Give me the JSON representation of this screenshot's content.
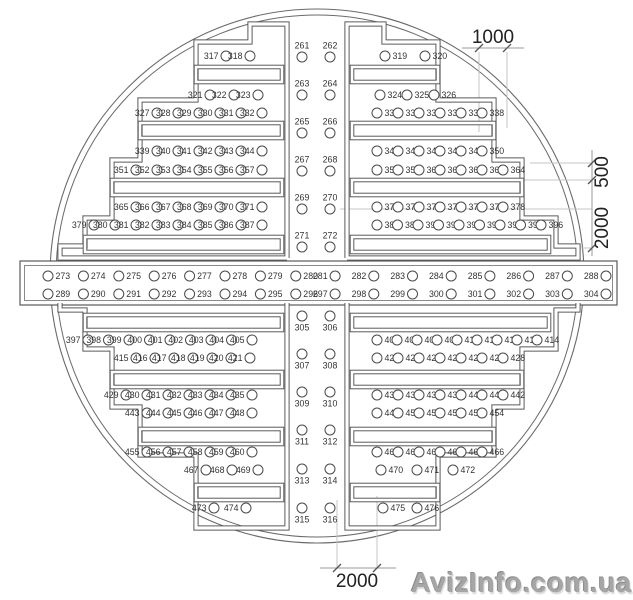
{
  "drawing": {
    "title": "circular-hole-layout-plan",
    "dimensions": {
      "top": "1000",
      "right_upper": "500",
      "right_lower": "2000",
      "bottom": "2000"
    },
    "watermark": "AvizInfo.com.ua",
    "colors": {
      "line": "#5a5a5a",
      "hole_stroke": "#4a4a4a",
      "dim_text": "#222222",
      "ext_line": "#c4c4c4",
      "watermark": "#a6a6a6"
    },
    "rows": [
      {
        "nums": [
          317,
          318
        ],
        "y": 56,
        "mode": "before",
        "x": 250,
        "step": 24
      },
      {
        "nums": [
          321,
          322,
          323
        ],
        "y": 95,
        "mode": "before",
        "x": 258,
        "step": 24
      },
      {
        "nums": [
          327,
          328,
          329,
          330,
          331,
          332
        ],
        "y": 113,
        "mode": "before",
        "x": 262,
        "step": 21
      },
      {
        "nums": [
          339,
          340,
          341,
          342,
          343,
          344
        ],
        "y": 151,
        "mode": "before",
        "x": 262,
        "step": 21
      },
      {
        "nums": [
          351,
          352,
          353,
          354,
          355,
          356,
          357
        ],
        "y": 170,
        "mode": "before",
        "x": 262,
        "step": 21
      },
      {
        "nums": [
          365,
          366,
          367,
          368,
          369,
          370,
          371
        ],
        "y": 207,
        "mode": "before",
        "x": 262,
        "step": 21
      },
      {
        "nums": [
          379,
          380,
          381,
          382,
          383,
          384,
          385,
          386,
          387
        ],
        "y": 225,
        "mode": "before",
        "x": 262,
        "step": 21
      },
      {
        "nums": [
          319,
          320
        ],
        "y": 56,
        "mode": "after",
        "x": 385,
        "step": 40
      },
      {
        "nums": [
          324,
          325,
          326
        ],
        "y": 95,
        "mode": "after",
        "x": 380,
        "step": 27
      },
      {
        "nums": [
          333,
          334,
          335,
          336,
          337,
          338
        ],
        "y": 113,
        "mode": "after",
        "x": 377,
        "step": 21
      },
      {
        "nums": [
          345,
          346,
          347,
          348,
          349,
          350
        ],
        "y": 151,
        "mode": "after",
        "x": 377,
        "step": 21
      },
      {
        "nums": [
          358,
          359,
          360,
          361,
          362,
          363,
          364
        ],
        "y": 170,
        "mode": "after",
        "x": 377,
        "step": 21
      },
      {
        "nums": [
          372,
          373,
          374,
          375,
          376,
          377,
          378
        ],
        "y": 207,
        "mode": "after",
        "x": 377,
        "step": 21
      },
      {
        "nums": [
          388,
          389,
          390,
          391,
          392,
          393,
          394,
          395,
          396
        ],
        "y": 225,
        "mode": "after",
        "x": 377,
        "step": 20.5
      },
      {
        "nums": [
          261,
          262
        ],
        "y": 57,
        "mode": "above",
        "x": 302,
        "step": 28
      },
      {
        "nums": [
          263,
          264
        ],
        "y": 95,
        "mode": "above",
        "x": 302,
        "step": 28
      },
      {
        "nums": [
          265,
          266
        ],
        "y": 133,
        "mode": "above",
        "x": 302,
        "step": 28
      },
      {
        "nums": [
          267,
          268
        ],
        "y": 171,
        "mode": "above",
        "x": 302,
        "step": 28
      },
      {
        "nums": [
          269,
          270
        ],
        "y": 209,
        "mode": "above",
        "x": 302,
        "step": 28
      },
      {
        "nums": [
          271,
          272
        ],
        "y": 247,
        "mode": "above",
        "x": 302,
        "step": 28
      },
      {
        "nums": [
          273,
          274,
          275,
          276,
          277,
          278,
          279,
          280
        ],
        "y": 276,
        "mode": "after",
        "x": 48,
        "step": 35.4
      },
      {
        "nums": [
          281,
          282,
          283,
          284,
          285,
          286,
          287,
          288
        ],
        "y": 276,
        "mode": "before",
        "x": 606,
        "step": 38.7
      },
      {
        "nums": [
          289,
          290,
          291,
          292,
          293,
          294,
          295,
          296
        ],
        "y": 294,
        "mode": "after",
        "x": 48,
        "step": 35.4
      },
      {
        "nums": [
          297,
          298,
          299,
          300,
          301,
          302,
          303,
          304
        ],
        "y": 294,
        "mode": "before",
        "x": 606,
        "step": 38.7
      },
      {
        "nums": [
          305,
          306
        ],
        "y": 316,
        "mode": "below",
        "x": 302,
        "step": 28
      },
      {
        "nums": [
          307,
          308
        ],
        "y": 354,
        "mode": "below",
        "x": 302,
        "step": 28
      },
      {
        "nums": [
          309,
          310
        ],
        "y": 392,
        "mode": "below",
        "x": 302,
        "step": 28
      },
      {
        "nums": [
          311,
          312
        ],
        "y": 430,
        "mode": "below",
        "x": 302,
        "step": 28
      },
      {
        "nums": [
          313,
          314
        ],
        "y": 469,
        "mode": "below",
        "x": 302,
        "step": 28
      },
      {
        "nums": [
          315,
          316
        ],
        "y": 508,
        "mode": "below",
        "x": 302,
        "step": 28
      },
      {
        "nums": [
          397,
          398,
          399,
          400,
          401,
          402,
          403,
          404,
          405
        ],
        "y": 340,
        "mode": "before",
        "x": 252,
        "step": 20.5
      },
      {
        "nums": [
          415,
          416,
          417,
          418,
          419,
          420,
          421
        ],
        "y": 358,
        "mode": "before",
        "x": 250,
        "step": 19
      },
      {
        "nums": [
          429,
          430,
          431,
          432,
          433,
          434,
          435
        ],
        "y": 395,
        "mode": "before",
        "x": 252,
        "step": 21
      },
      {
        "nums": [
          443,
          444,
          445,
          446,
          447,
          448
        ],
        "y": 413,
        "mode": "before",
        "x": 252,
        "step": 21
      },
      {
        "nums": [
          455,
          456,
          457,
          458,
          459,
          460
        ],
        "y": 452,
        "mode": "before",
        "x": 252,
        "step": 21
      },
      {
        "nums": [
          467,
          468,
          469
        ],
        "y": 470,
        "mode": "before",
        "x": 258,
        "step": 26
      },
      {
        "nums": [
          473,
          474
        ],
        "y": 508,
        "mode": "before",
        "x": 246,
        "step": 32
      },
      {
        "nums": [
          406,
          407,
          408,
          409,
          410,
          411,
          412,
          413,
          414
        ],
        "y": 340,
        "mode": "after",
        "x": 377,
        "step": 20
      },
      {
        "nums": [
          422,
          423,
          424,
          425,
          426,
          427,
          428
        ],
        "y": 358,
        "mode": "after",
        "x": 377,
        "step": 21
      },
      {
        "nums": [
          436,
          437,
          438,
          439,
          440,
          441,
          442
        ],
        "y": 395,
        "mode": "after",
        "x": 377,
        "step": 21
      },
      {
        "nums": [
          449,
          450,
          451,
          452,
          453,
          454
        ],
        "y": 413,
        "mode": "after",
        "x": 377,
        "step": 21
      },
      {
        "nums": [
          461,
          462,
          463,
          464,
          465,
          466
        ],
        "y": 452,
        "mode": "after",
        "x": 377,
        "step": 21
      },
      {
        "nums": [
          470,
          471,
          472
        ],
        "y": 470,
        "mode": "after",
        "x": 381,
        "step": 36
      },
      {
        "nums": [
          475,
          476
        ],
        "y": 508,
        "mode": "after",
        "x": 383,
        "step": 34
      }
    ]
  }
}
